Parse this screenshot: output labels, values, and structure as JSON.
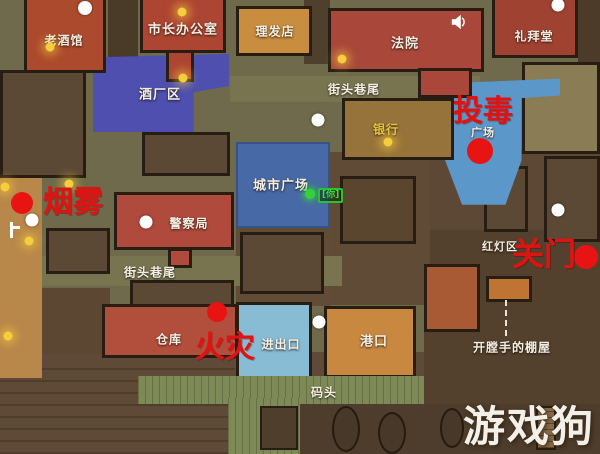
{
  "map": {
    "region_labels": [
      {
        "id": "tavern",
        "label": "老酒馆"
      },
      {
        "id": "mayor-office",
        "label": "市长办公室"
      },
      {
        "id": "barbershop",
        "label": "理发店"
      },
      {
        "id": "courthouse",
        "label": "法院"
      },
      {
        "id": "chapel",
        "label": "礼拜堂"
      },
      {
        "id": "brewery-district",
        "label": "酒厂区"
      },
      {
        "id": "street-corner-north",
        "label": "街头巷尾"
      },
      {
        "id": "bank",
        "label": "银行"
      },
      {
        "id": "plaza",
        "label": "广场"
      },
      {
        "id": "city-plaza",
        "label": "城市广场"
      },
      {
        "id": "police-station",
        "label": "警察局"
      },
      {
        "id": "red-light-district",
        "label": "红灯区"
      },
      {
        "id": "street-corner-west",
        "label": "街头巷尾"
      },
      {
        "id": "warehouse",
        "label": "仓库"
      },
      {
        "id": "entrance-exit",
        "label": "进出口"
      },
      {
        "id": "port",
        "label": "港口"
      },
      {
        "id": "ripper-shack",
        "label": "开膛手的棚屋"
      },
      {
        "id": "dock",
        "label": "码头"
      }
    ],
    "event_markers": [
      {
        "id": "smoke",
        "label": "烟雾"
      },
      {
        "id": "poison",
        "label": "投毒"
      },
      {
        "id": "door-close",
        "label": "关门"
      },
      {
        "id": "fire",
        "label": "火灾"
      }
    ],
    "player_marker": {
      "label": "[你]"
    },
    "watermark": {
      "text": "游戏狗"
    },
    "colors": {
      "event_text_red": "#e01313",
      "marker_red": "#e81414",
      "marker_white": "#ffffff",
      "lamp_yellow": "#f6cd3a",
      "player_green": "#34d23a",
      "bank_label_yellow": "#e6c53e",
      "zone_blue_brewery": "#4e4fae",
      "zone_blue_city_plaza": "#4769a5",
      "zone_blue_plaza": "#5b97c8",
      "zone_blue_entrance": "#88bcd4",
      "zone_red_building": "#a8473a",
      "zone_orange_building": "#c8883e"
    }
  }
}
